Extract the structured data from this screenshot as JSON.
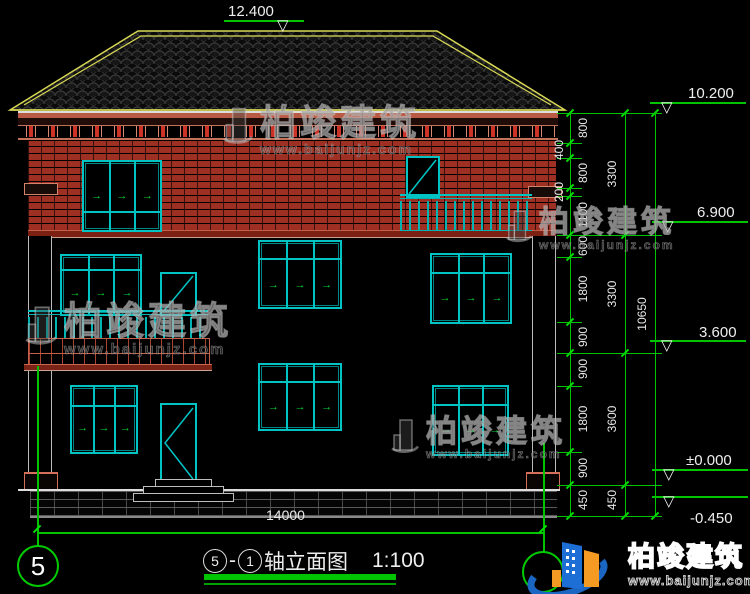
{
  "levels": {
    "top": "12.400",
    "right": [
      "10.200",
      "6.900",
      "3.600",
      "±0.000",
      "-0.450"
    ]
  },
  "dims": {
    "inner": [
      "800",
      "400",
      "800",
      "200",
      "1100",
      "600",
      "1800",
      "900",
      "900",
      "1800",
      "900",
      "450"
    ],
    "mid": [
      "3300",
      "3300",
      "3600",
      "450"
    ],
    "overall": "10650",
    "bottom": "14000"
  },
  "axis": {
    "left": "5"
  },
  "title": {
    "start": "5",
    "sep": "-",
    "end": "1",
    "name": "轴立面图",
    "scale": "1:100"
  },
  "watermark": {
    "name": "柏竣建筑",
    "url": "www.baijunjz.com"
  },
  "brand": {
    "name": "柏竣建筑",
    "url": "www.baijunjz.com"
  },
  "icons": {
    "opening_arrow": "→"
  }
}
